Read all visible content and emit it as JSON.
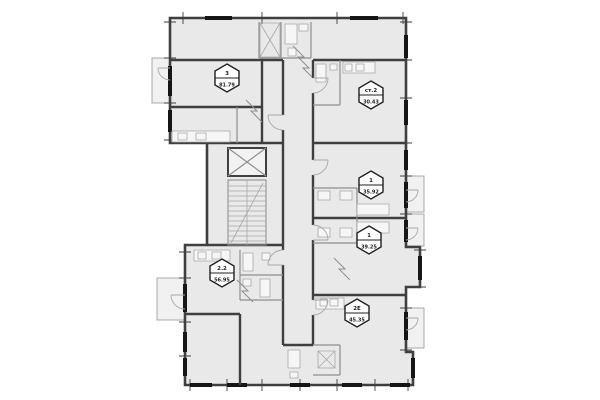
{
  "plan": {
    "colors": {
      "wall": "#3f3f3f",
      "room_fill": "#e9e9e9",
      "balcony_fill": "#f1f1f1",
      "partition": "#8f8f8f",
      "detail": "#a8a8a8",
      "window": "#161616",
      "badge_fill": "#ffffff",
      "badge_border": "#1f1f1f",
      "badge_text": "#1f1f1f"
    },
    "units": [
      {
        "id": "3",
        "type": "3",
        "area": "81.79"
      },
      {
        "id": "st2",
        "type": "ст.2",
        "area": "30.43"
      },
      {
        "id": "1a",
        "type": "1",
        "area": "35.92"
      },
      {
        "id": "1b",
        "type": "1",
        "area": "39.25"
      },
      {
        "id": "22",
        "type": "2.2",
        "area": "56.95"
      },
      {
        "id": "2e",
        "type": "2Е",
        "area": "45.35"
      }
    ]
  }
}
